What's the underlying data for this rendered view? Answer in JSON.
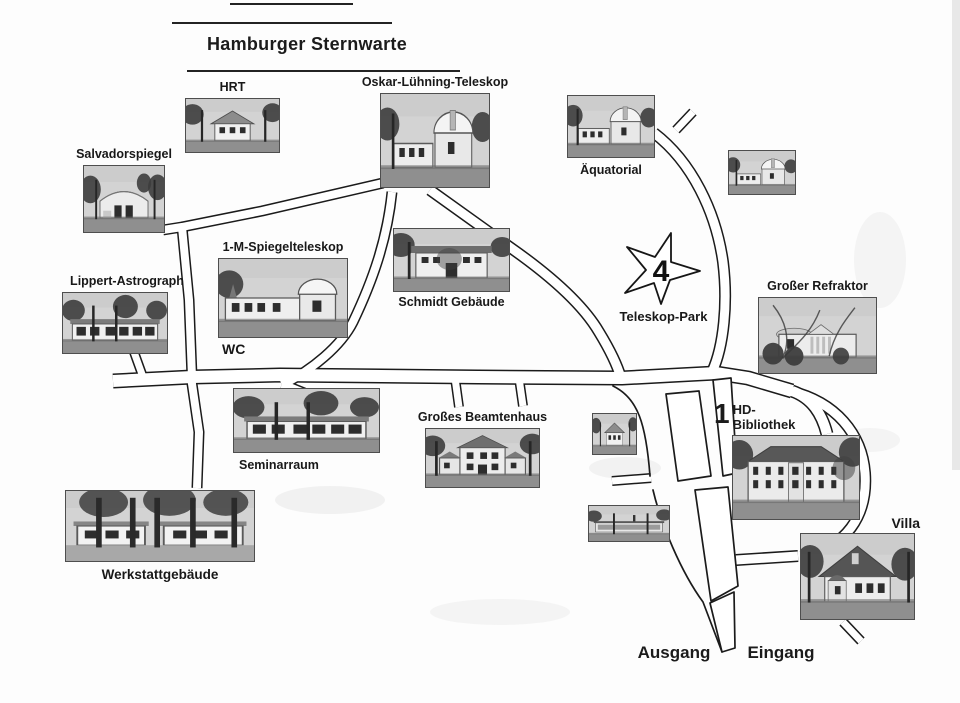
{
  "title": "Hamburger Sternwarte",
  "map": {
    "wc_label": "WC",
    "star": {
      "number": "4",
      "label": "Teleskop-Park"
    },
    "hd": {
      "number": "1",
      "line1": "HD-",
      "line2": "Bibliothek"
    },
    "exits": {
      "ausgang": "Ausgang",
      "eingang": "Eingang"
    },
    "ink_color": "#1b1b1b",
    "road_fill": "#ffffff",
    "buildings": [
      {
        "id": "hrt",
        "label": "HRT"
      },
      {
        "id": "oskar-luehning-teleskop",
        "label": "Oskar-Lühning-Teleskop"
      },
      {
        "id": "aequatorial",
        "label": "Äquatorial"
      },
      {
        "id": "kuppel-pavillon",
        "label": ""
      },
      {
        "id": "salvadorspiegel",
        "label": "Salvadorspiegel"
      },
      {
        "id": "lippert-astrograph",
        "label": "Lippert-Astrograph"
      },
      {
        "id": "1-m-spiegelteleskop",
        "label": "1-M-Spiegelteleskop"
      },
      {
        "id": "schmidt-gebaeude",
        "label": "Schmidt Gebäude"
      },
      {
        "id": "grosser-refraktor",
        "label": "Großer Refraktor"
      },
      {
        "id": "seminarraum",
        "label": "Seminarraum"
      },
      {
        "id": "grosses-beamtenhaus",
        "label": "Großes Beamtenhaus"
      },
      {
        "id": "kleines-haus",
        "label": ""
      },
      {
        "id": "pavillon",
        "label": ""
      },
      {
        "id": "hd-bibliothek",
        "label": "HD-Bibliothek"
      },
      {
        "id": "villa",
        "label": "Villa"
      },
      {
        "id": "werkstattgebaeude",
        "label": "Werkstattgebäude"
      }
    ]
  }
}
